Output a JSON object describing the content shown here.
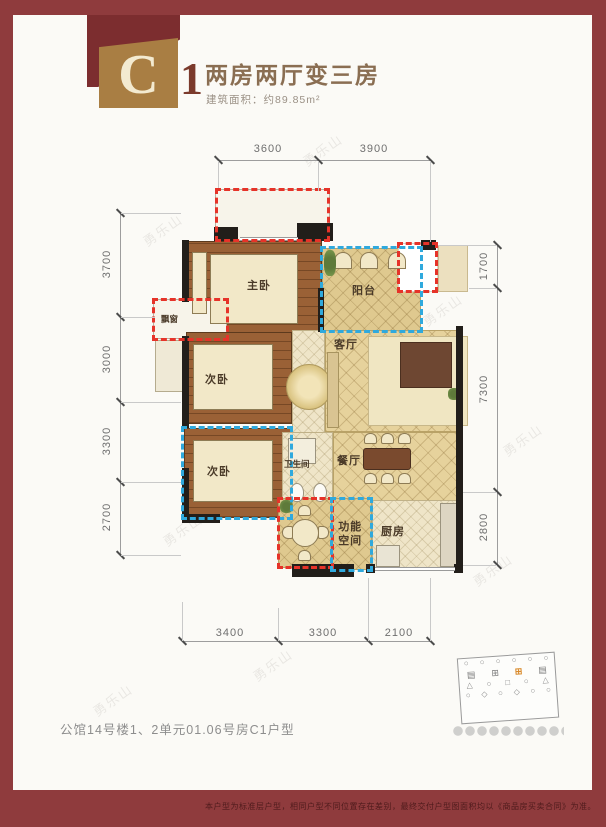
{
  "badge": {
    "letter": "C",
    "number": "1"
  },
  "header": {
    "title": "两房两厅变三房",
    "area": "建筑面积：约89.85m²"
  },
  "rooms": {
    "master": "主卧",
    "bedroom2": "次卧",
    "bedroom3": "次卧",
    "bay": "飘窗",
    "balcony": "阳台",
    "living": "客厅",
    "dining": "餐厅",
    "bath": "卫生间",
    "multi": "功能空间",
    "kitchen": "厨房"
  },
  "dimensions": {
    "top": [
      "3600",
      "3900"
    ],
    "left": [
      "3700",
      "3000",
      "3300",
      "2700"
    ],
    "right": [
      "1700",
      "7300",
      "2800"
    ],
    "bottom": [
      "3400",
      "3300",
      "2100"
    ]
  },
  "footer": {
    "unit": "公馆14号楼1、2单元01.06号房C1户型",
    "disclaimer": "本户型为标准层户型，相同户型不同位置存在差别，最终交付户型图面积均以《商品房买卖合同》为准。"
  },
  "watermark": "勇乐山",
  "colors": {
    "frame": "#8F3B3D",
    "badge_gold": "#A97E43",
    "highlight_red": "#E63329",
    "highlight_blue": "#2FA9DD"
  }
}
